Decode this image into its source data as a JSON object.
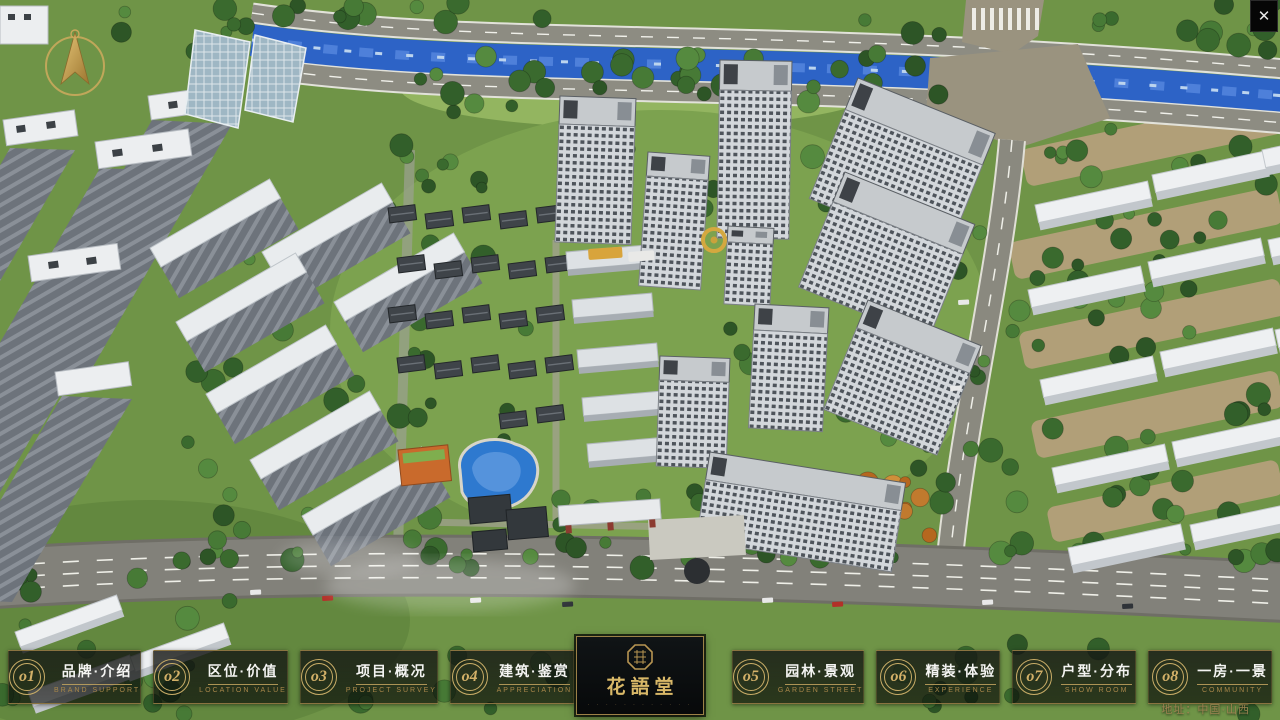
{
  "window": {
    "close_glyph": "✕"
  },
  "scene": {
    "description": "aerial-3d-masterplan-render",
    "colors": {
      "grass": "#6f9447",
      "river": "#2d63c6",
      "road": "#84837a",
      "gold": "#c9ad67"
    }
  },
  "nav": {
    "accent_color": "#c9ad67",
    "items": [
      {
        "num": "o1",
        "label": "品牌·介绍",
        "sub": "BRAND SUPPORT"
      },
      {
        "num": "o2",
        "label": "区位·价值",
        "sub": "LOCATION VALUE"
      },
      {
        "num": "o3",
        "label": "项目·概况",
        "sub": "PROJECT SURVEY"
      },
      {
        "num": "o4",
        "label": "建筑·鉴赏",
        "sub": "APPRECIATION"
      },
      {
        "num": "o5",
        "label": "园林·景观",
        "sub": "GARDEN STREET"
      },
      {
        "num": "o6",
        "label": "精装·体验",
        "sub": "EXPERIENCE"
      },
      {
        "num": "o7",
        "label": "户型·分布",
        "sub": "SHOW ROOM"
      },
      {
        "num": "o8",
        "label": "一房·一景",
        "sub": "COMMUNITY"
      }
    ],
    "logo": {
      "title": "花語堂",
      "tagline": "· · · · · · · · · · · ·"
    }
  },
  "footer": {
    "address": "地址：中国·山西"
  }
}
